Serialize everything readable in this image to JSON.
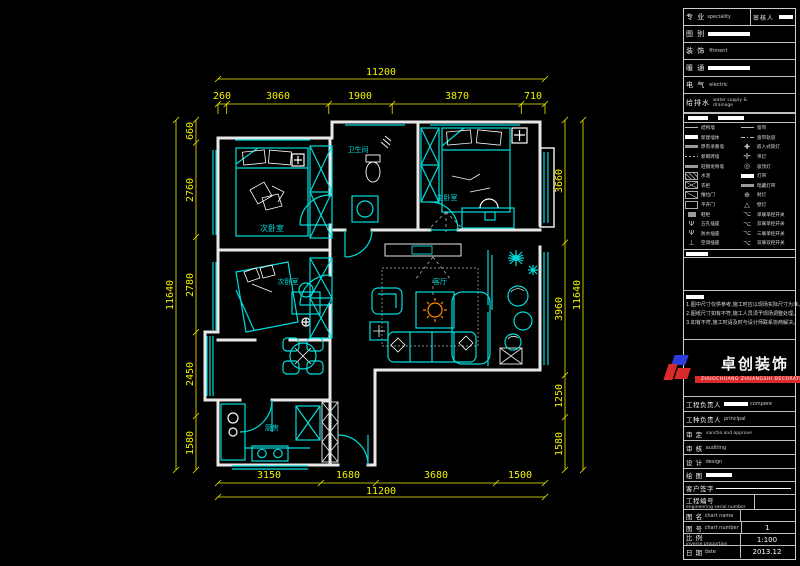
{
  "colors": {
    "background": "#000000",
    "walls": "#e8e8e8",
    "furniture_cyan": "#00dcdc",
    "dimension_yellow": "#f0f000",
    "accent_orange": "#ff8a00",
    "logo_red": "#d92b2b",
    "logo_blue": "#2b3cd9"
  },
  "plan": {
    "rooms": [
      {
        "name": "次卧室"
      },
      {
        "name": "卫生间"
      },
      {
        "name": "主卧室"
      },
      {
        "name": "次卧室"
      },
      {
        "name": "客厅"
      },
      {
        "name": "厨房"
      }
    ],
    "dimensions": {
      "top_total": "11200",
      "top": [
        "260",
        "3060",
        "1900",
        "3870",
        "710"
      ],
      "bottom": [
        "3150",
        "1680",
        "3680",
        "1500"
      ],
      "bottom_total": "11200",
      "left": [
        "660",
        "2760",
        "2780",
        "2450",
        "1580"
      ],
      "left_total": "11640",
      "right": [
        "3660",
        "3960",
        "1250",
        "1580"
      ],
      "right_total": "11640"
    }
  },
  "panel": {
    "header": {
      "r1_zh": "专 业",
      "r1_en": "speciality",
      "r1_right_zh": "审核人",
      "r2_zh": "图 别",
      "r3_zh": "装 饰",
      "r3_en": "fitment",
      "r4_zh": "暖 通",
      "r5_zh": "电 气",
      "r5_en": "electric",
      "r6_zh": "给排水",
      "r6_en1": "water supply &",
      "r6_en2": "drainage"
    },
    "legend": {
      "rows": [
        {
          "l": "结构墙",
          "r": "窗帘"
        },
        {
          "l": "新建墙体",
          "r": "窗帘轨道"
        },
        {
          "l": "原有承重墙",
          "r": "嵌入式筒灯"
        },
        {
          "l": "新砌砖墙",
          "r": "吊灯"
        },
        {
          "l": "轻钢龙骨墙",
          "r": "吸顶灯"
        },
        {
          "l": "水泥",
          "r": "灯带"
        },
        {
          "l": "衣柜",
          "r": "暗藏灯带"
        },
        {
          "l": "推拉门",
          "r": "射灯"
        },
        {
          "l": "平开门",
          "r": "壁灯"
        },
        {
          "l": "鞋柜",
          "r": "单联单控开关"
        },
        {
          "l": "五孔插座",
          "r": "双联单控开关"
        },
        {
          "l": "防水插座",
          "r": "三联单控开关"
        },
        {
          "l": "空调插座",
          "r": "双联双控开关"
        }
      ]
    },
    "notes": {
      "title": "说明:",
      "items": [
        "1.图中尺寸仅供参考,施工时应以现场实际尺寸为准。",
        "2.图纸尺寸如有不符,施工人员须予现场调整处理。",
        "3.如有不符,施工时请及时与设计师联系协商解决。"
      ]
    },
    "logo": {
      "cn": "卓创装饰",
      "sub": "ZHUOCHUANG ZHUANGSHI DECORATION"
    },
    "sign_rows": [
      {
        "zh": "工程负责人",
        "en": "compere"
      },
      {
        "zh": "工种负责人",
        "en": "principal"
      },
      {
        "zh": "审  定",
        "en": "sanctio and approve"
      },
      {
        "zh": "审  核",
        "en": "auditing"
      },
      {
        "zh": "设  计",
        "en": "design"
      },
      {
        "zh": "绘  图",
        "en": ""
      },
      {
        "zh": "客户签字",
        "en": ""
      }
    ],
    "info_rows": [
      {
        "zh": "工程编号",
        "en": "engineering serial number",
        "value": ""
      },
      {
        "zh": "图  名",
        "en": "chart name",
        "value": ""
      },
      {
        "zh": "图  号",
        "en": "chart number",
        "value": "1"
      },
      {
        "zh": "比  例",
        "en": "inverse proportion",
        "value": "1:100"
      },
      {
        "zh": "日  期",
        "en": "date",
        "value": "2013.12"
      }
    ]
  }
}
